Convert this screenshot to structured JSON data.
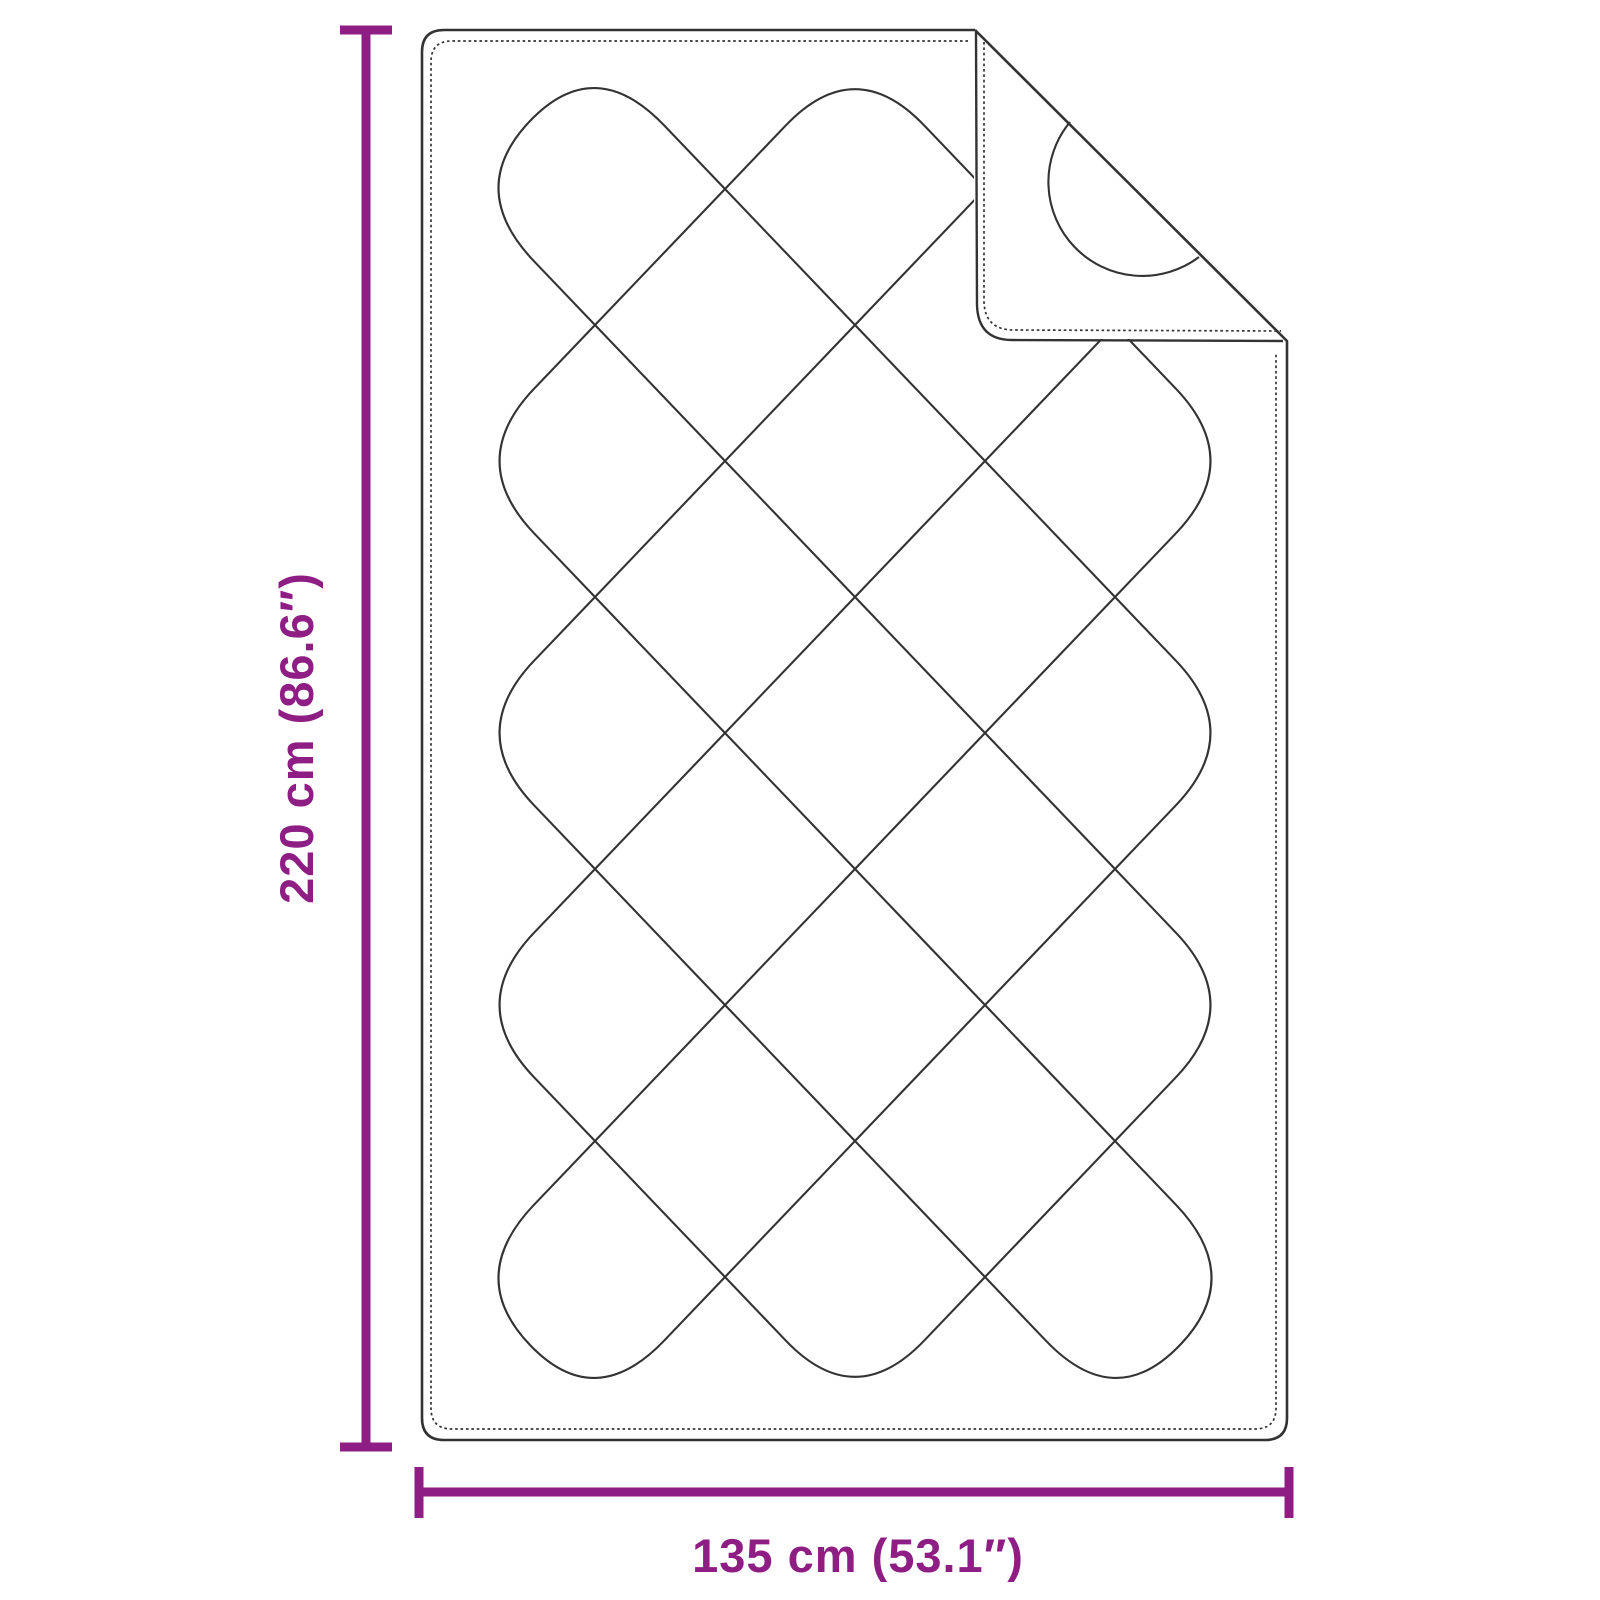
{
  "diagram": {
    "height_label": "220 cm (86.6″)",
    "width_label": "135 cm (53.1″)"
  },
  "colors": {
    "dimension_accent": "#8e1d84",
    "outline": "#333333",
    "background": "#ffffff"
  }
}
